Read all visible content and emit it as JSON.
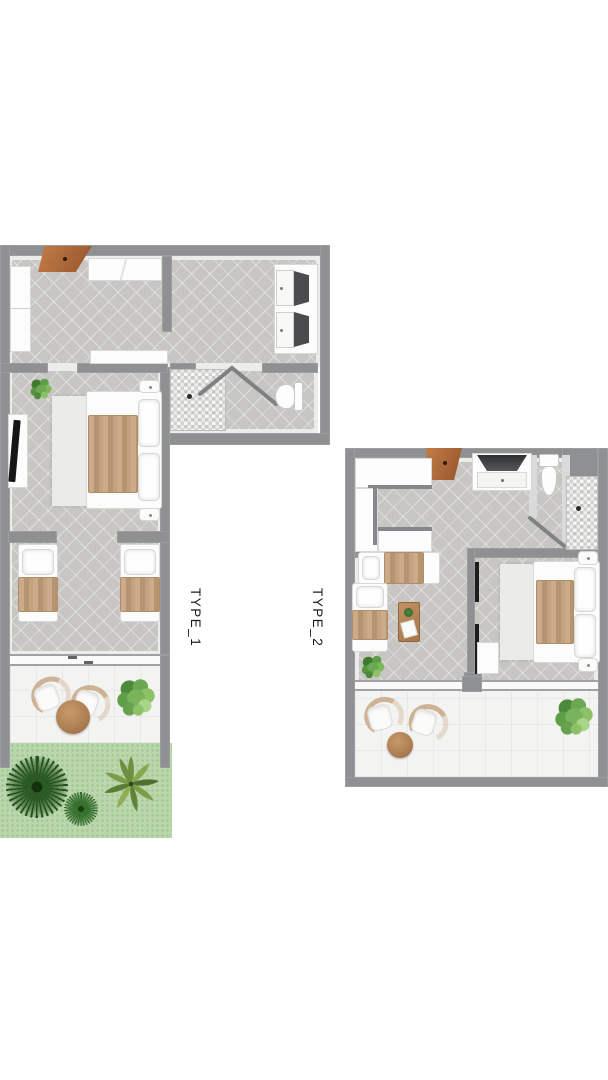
{
  "canvas": {
    "width": 608,
    "height": 1080,
    "background": "#ffffff"
  },
  "plans": [
    {
      "id": "type-1",
      "label": "TYPE_1"
    },
    {
      "id": "type-2",
      "label": "TYPE_2"
    }
  ],
  "palette": {
    "wall_gray": "#8e9092",
    "floor_tile_gray": "#c7c6c3",
    "terrace_tile_white": "#f3f3f1",
    "grass_green": "#b9d7ab",
    "wood_door_brown": "#b5703f",
    "blanket_tan": "#c0a17f",
    "table_wood_brown": "#b5835a",
    "plant_dark_green": "#2f5a26",
    "plant_light_green": "#7fb75d",
    "furniture_white": "#fcfcfc",
    "sliding_door_black": "#1d1d1d",
    "label_text": "#1b1b1b"
  }
}
